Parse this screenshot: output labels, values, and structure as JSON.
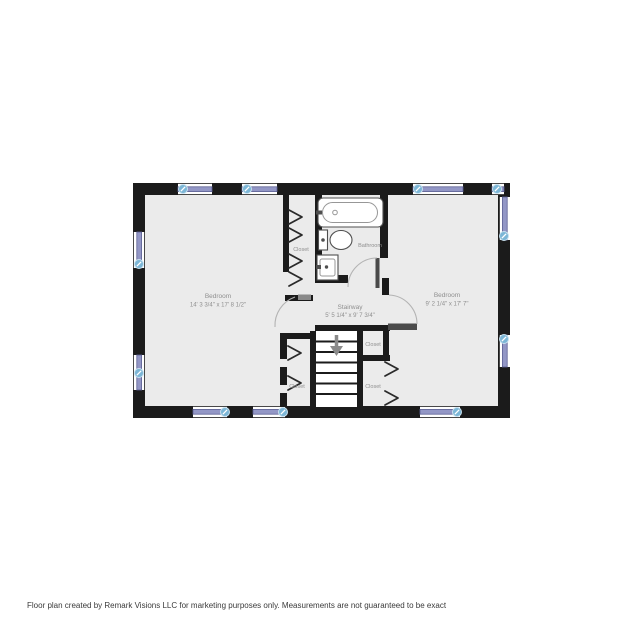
{
  "floor_plan": {
    "rooms": {
      "bedroom_left": {
        "name": "Bedroom",
        "dimensions": "14' 3 3/4\" x 17' 8 1/2\""
      },
      "bedroom_right": {
        "name": "Bedroom",
        "dimensions": "9' 2 1/4\" x 17' 7\""
      },
      "stairway": {
        "name": "Stairway",
        "dimensions": "5' 5 1/4\" x 9' 7 3/4\""
      },
      "bathroom": {
        "name": "Bathroom"
      },
      "closet_upper_left": {
        "name": "Closet"
      },
      "closet_lower_left": {
        "name": "Closet"
      },
      "closet_right_upper": {
        "name": "Closet"
      },
      "closet_right_lower": {
        "name": "Closet"
      }
    },
    "colors": {
      "wall": "#1b1b1b",
      "floor": "#ebebeb",
      "window": "#9397c6",
      "window-edge": "#5d6194",
      "hotspot": "#7cb6d6",
      "hotspot-ring": "#c9e2f0",
      "label": "#8f8f8f",
      "fixture": "#4f4f4f",
      "door-arc": "#b3b3b3",
      "door-leaf": "#4a4a4a"
    }
  },
  "footer": {
    "text": "Floor plan created by Remark Visions LLC for marketing purposes only. Measurements are not guaranteed to be exact"
  }
}
